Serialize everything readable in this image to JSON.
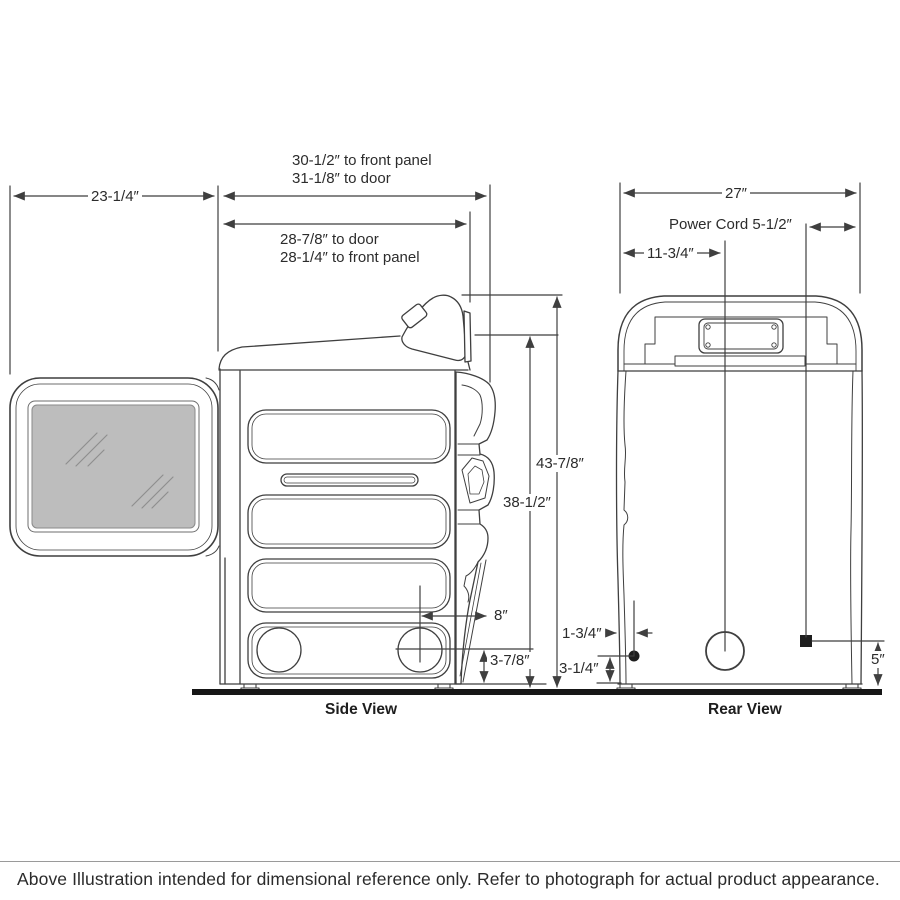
{
  "side_view": {
    "title": "Side View",
    "dims": {
      "depth_total_panel": "30-1/2″ to front panel",
      "depth_total_door": "31-1/8″ to door",
      "door_swing": "23-1/4″",
      "depth_door": "28-7/8″ to door",
      "depth_panel": "28-1/4″ to front panel",
      "height_total": "43-7/8″",
      "height_cabinet": "38-1/2″",
      "vent_setback": "8″",
      "vent_height": "3-7/8″"
    }
  },
  "rear_view": {
    "title": "Rear View",
    "dims": {
      "width": "27″",
      "power_cord": "Power Cord 5-1/2″",
      "vent_offset": "11-3/4″",
      "gas_offset": "1-3/4″",
      "gas_height": "3-1/4″",
      "cord_height": "5″"
    }
  },
  "footnote": "Above Illustration intended for dimensional reference only. Refer to photograph for actual product appearance.",
  "colors": {
    "line": "#3f3f3f",
    "glass_fill": "#bdbdbd",
    "floor": "#161616"
  }
}
